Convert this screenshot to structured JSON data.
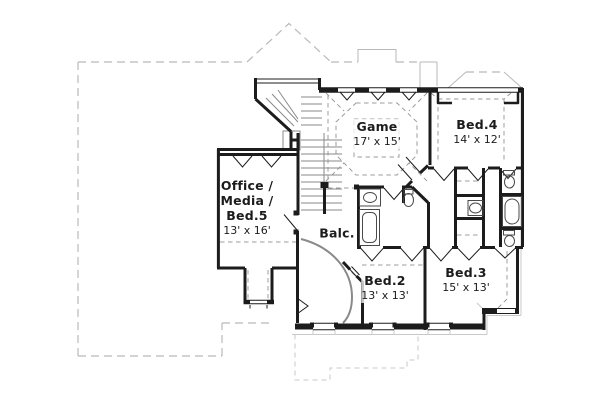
{
  "page": {
    "background": "#ffffff"
  },
  "colors": {
    "background": "#ffffff",
    "wall": "#1c1c1c",
    "roofline": "#b9b9b9",
    "eave": "#c9c9c9",
    "ceiling_dash": "#9c9c9c",
    "fixture": "#4a4a4a",
    "stair": "#8a8a8a",
    "text": "#1c1c1c"
  },
  "rooms": {
    "game": {
      "name": "Game",
      "dims": "17' x 15'"
    },
    "bed4": {
      "name": "Bed.4",
      "dims": "14' x 12'"
    },
    "office": {
      "line1": "Office /",
      "line2": "Media /",
      "line3": "Bed.5",
      "dims": "13' x 16'"
    },
    "balcony": {
      "name": "Balc."
    },
    "bed2": {
      "name": "Bed.2",
      "dims": "13' x 13'"
    },
    "bed3": {
      "name": "Bed.3",
      "dims": "15' x 13'"
    }
  }
}
